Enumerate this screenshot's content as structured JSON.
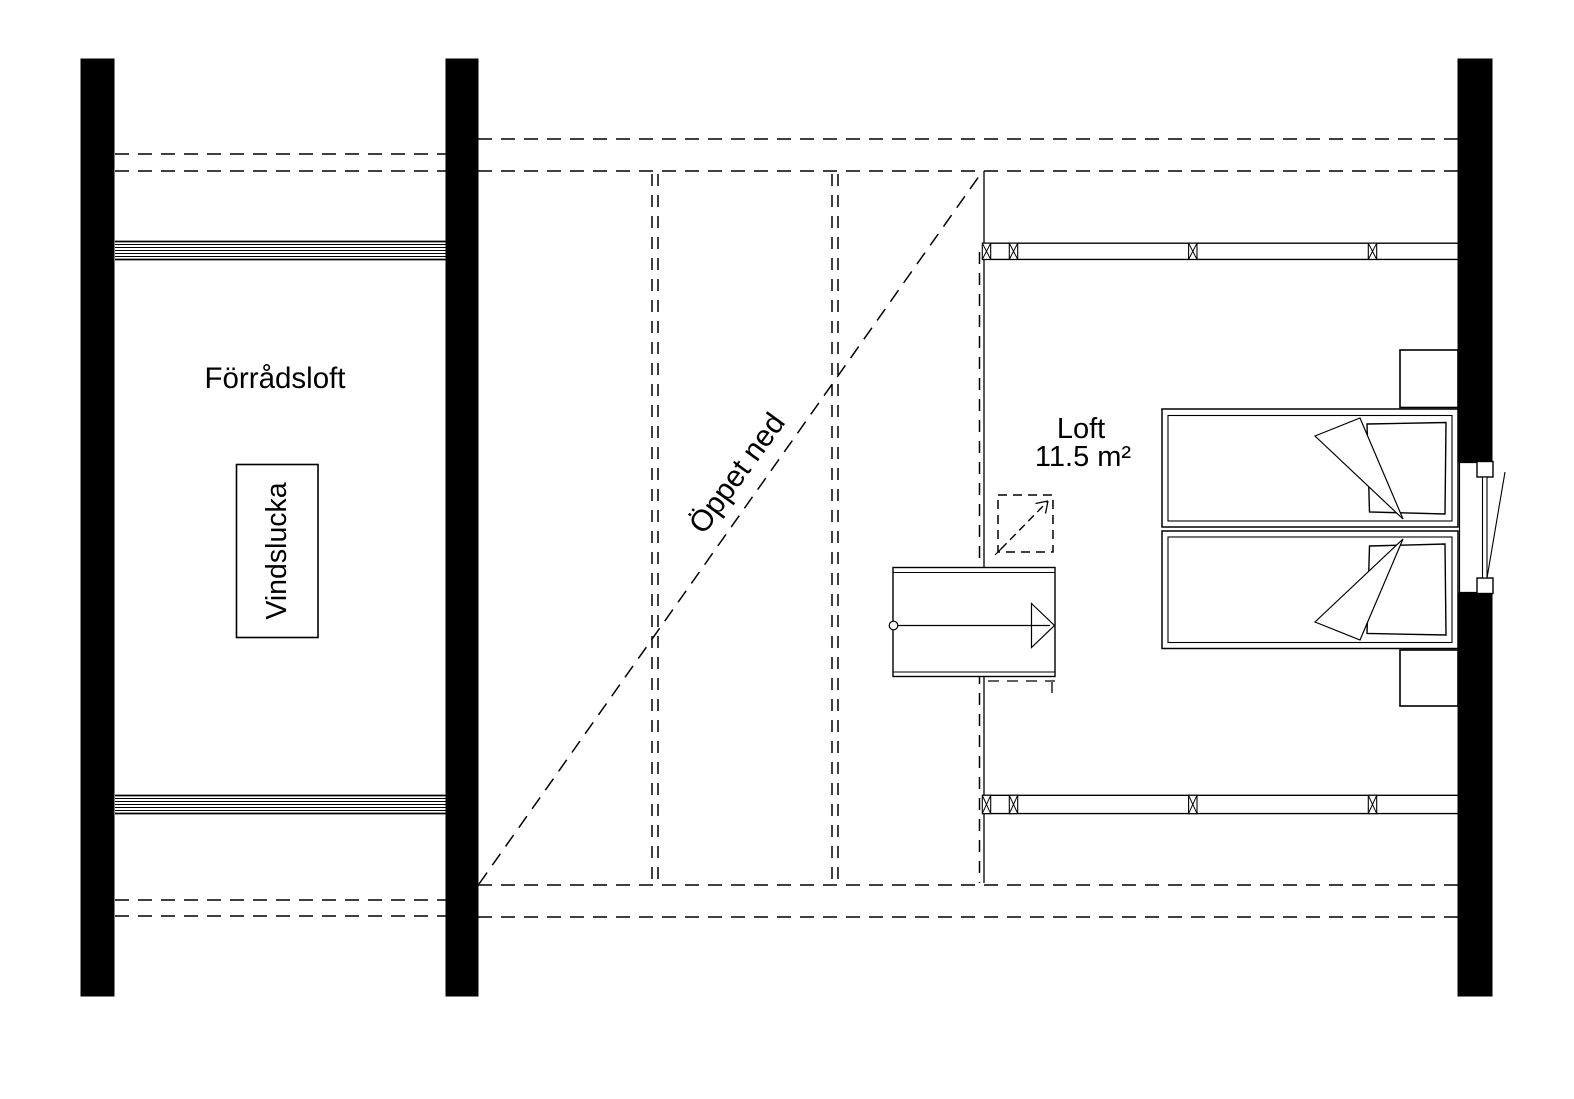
{
  "plan": {
    "labels": {
      "storage_loft": "Förrådsloft",
      "attic_hatch": "Vindslucka",
      "open_below": "Öppet ned",
      "loft_name": "Loft",
      "loft_area": "11.5 m²"
    },
    "colors": {
      "line": "#000000",
      "background": "#ffffff"
    }
  }
}
